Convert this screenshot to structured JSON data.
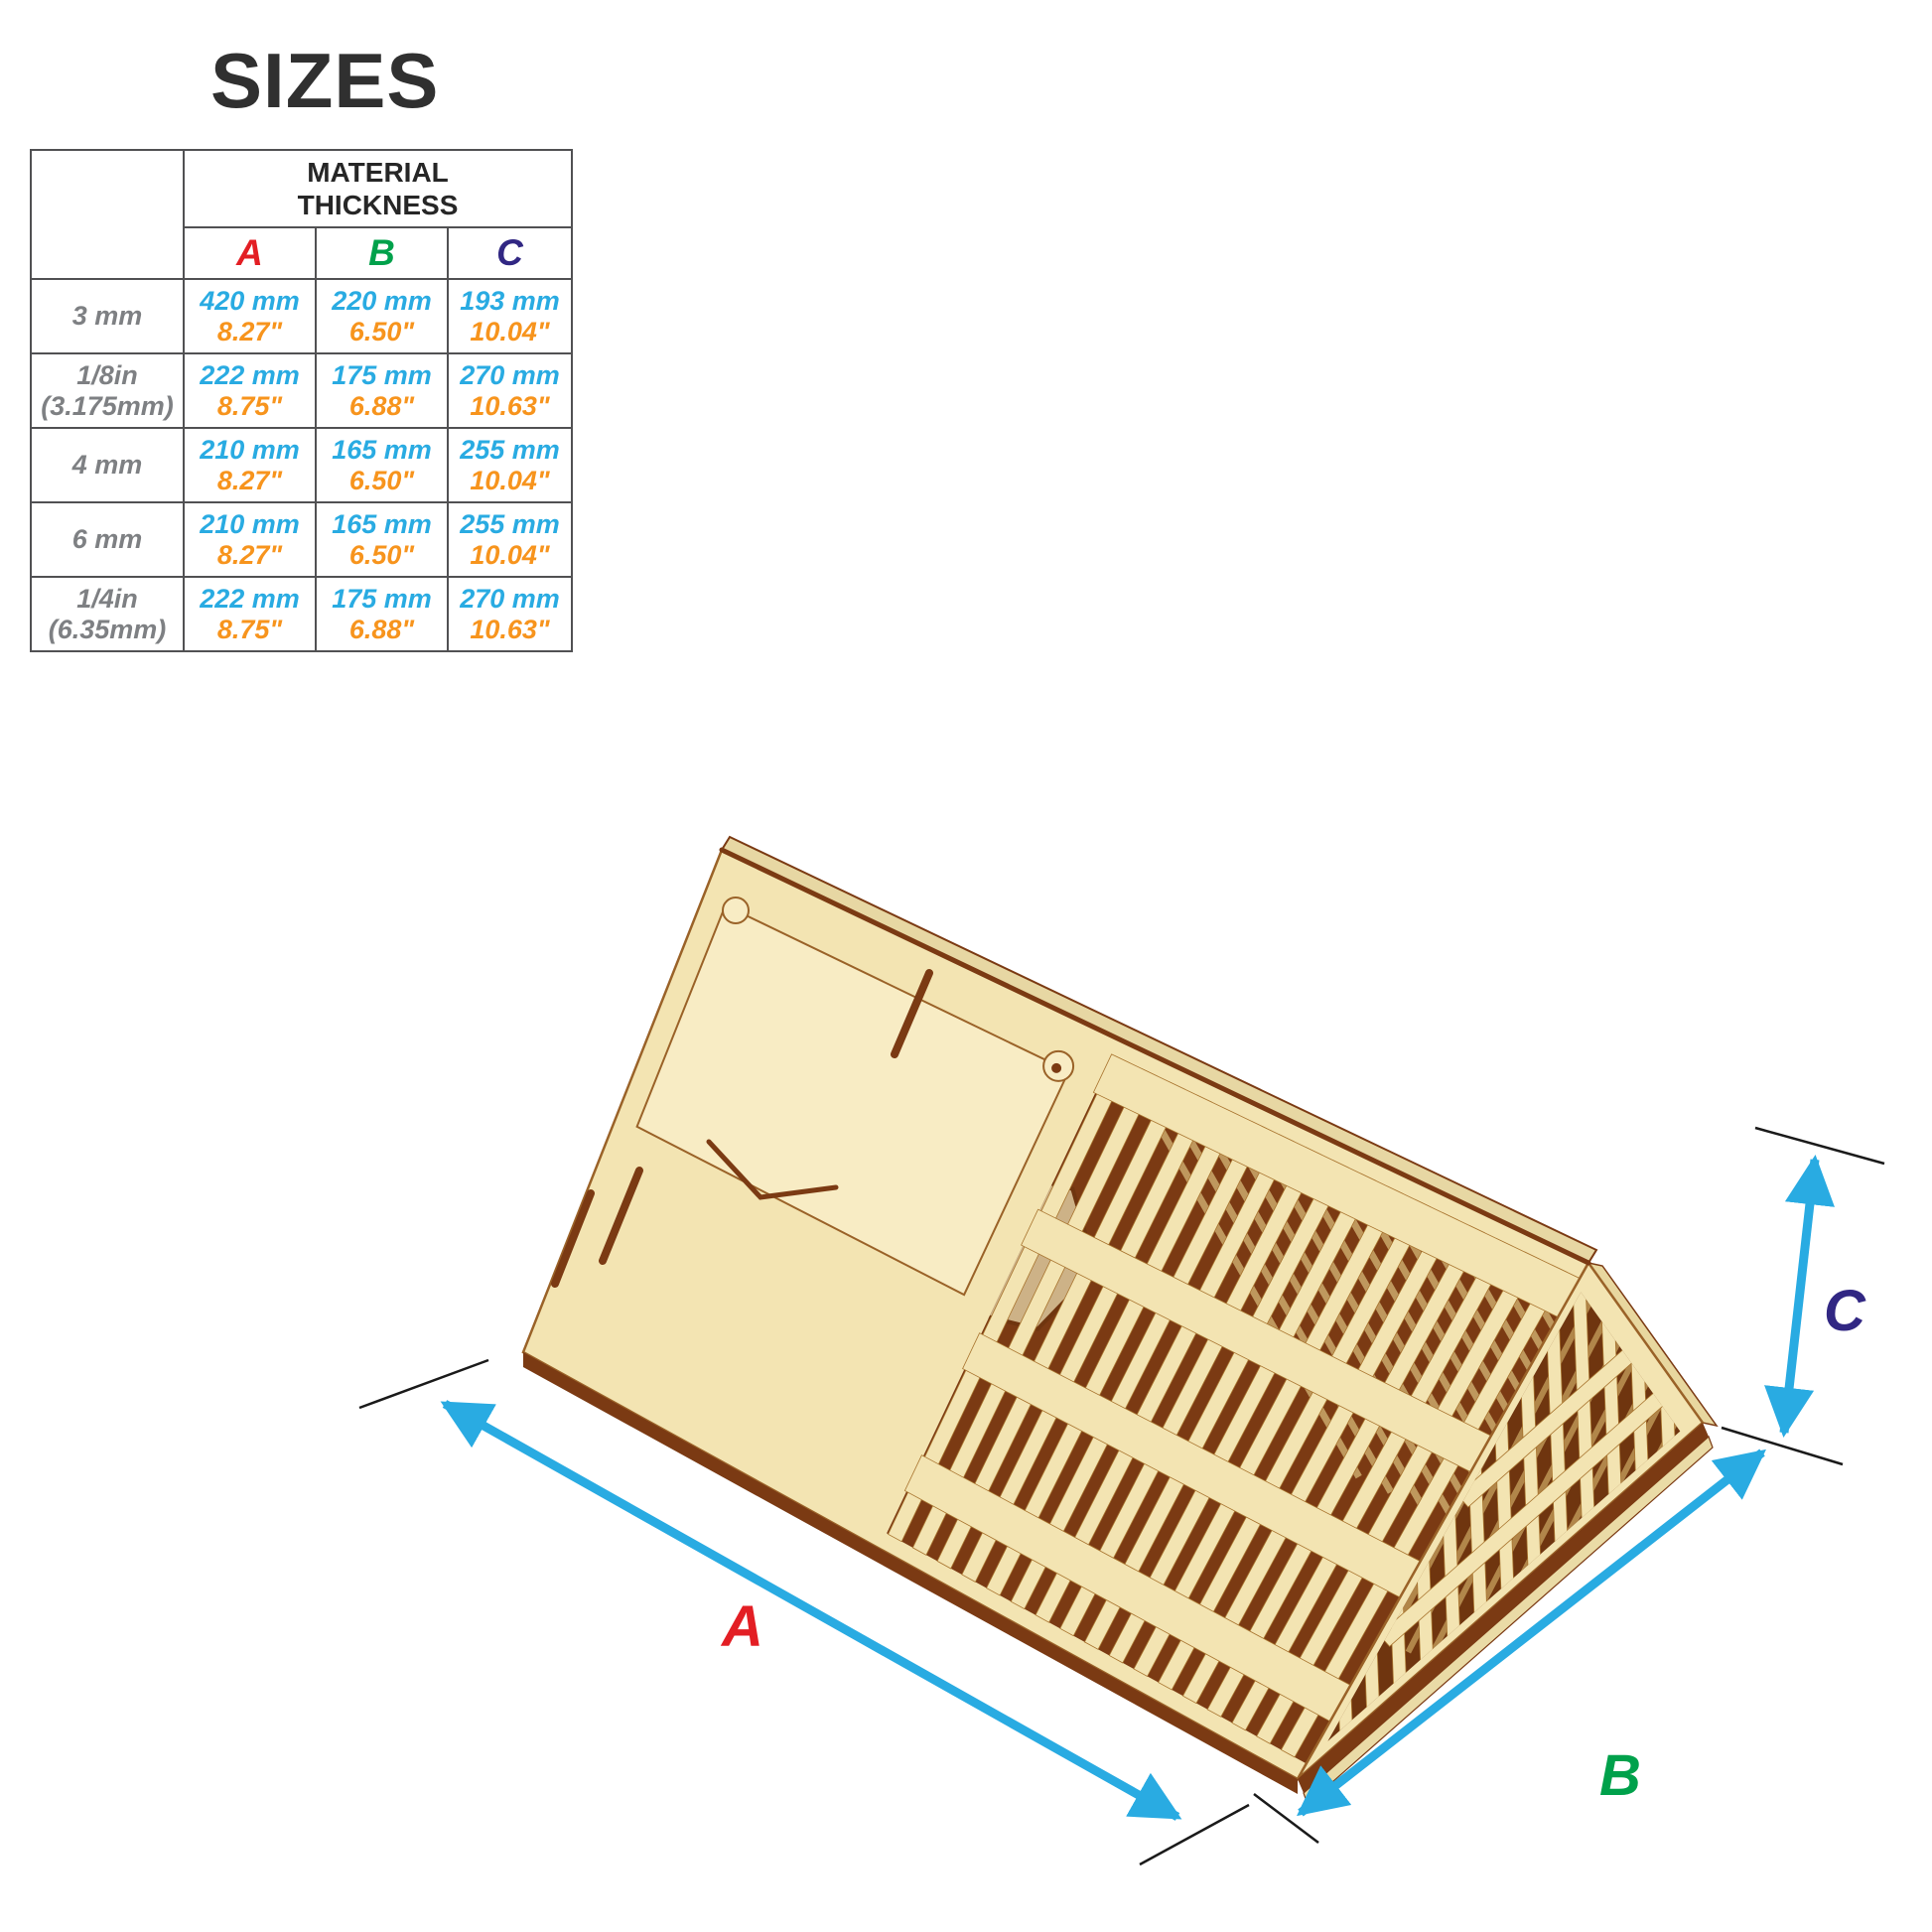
{
  "title": "SIZES",
  "table": {
    "corner_label": "",
    "header_line1": "MATERIAL",
    "header_line2": "THICKNESS",
    "columns": [
      {
        "key": "A",
        "color": "#E31E24"
      },
      {
        "key": "B",
        "color": "#00A14B"
      },
      {
        "key": "C",
        "color": "#312783"
      }
    ],
    "rows": [
      {
        "label1": "3 mm",
        "label2": "",
        "cells": [
          {
            "mm": "420 mm",
            "in": "8.27\""
          },
          {
            "mm": "220 mm",
            "in": "6.50\""
          },
          {
            "mm": "193 mm",
            "in": "10.04\""
          }
        ]
      },
      {
        "label1": "1/8in",
        "label2": "(3.175mm)",
        "cells": [
          {
            "mm": "222 mm",
            "in": "8.75\""
          },
          {
            "mm": "175 mm",
            "in": "6.88\""
          },
          {
            "mm": "270 mm",
            "in": "10.63\""
          }
        ]
      },
      {
        "label1": "4 mm",
        "label2": "",
        "cells": [
          {
            "mm": "210 mm",
            "in": "8.27\""
          },
          {
            "mm": "165 mm",
            "in": "6.50\""
          },
          {
            "mm": "255 mm",
            "in": "10.04\""
          }
        ]
      },
      {
        "label1": "6 mm",
        "label2": "",
        "cells": [
          {
            "mm": "210 mm",
            "in": "8.27\""
          },
          {
            "mm": "165 mm",
            "in": "6.50\""
          },
          {
            "mm": "255 mm",
            "in": "10.04\""
          }
        ]
      },
      {
        "label1": "1/4in",
        "label2": "(6.35mm)",
        "cells": [
          {
            "mm": "222 mm",
            "in": "8.75\""
          },
          {
            "mm": "175 mm",
            "in": "6.88\""
          },
          {
            "mm": "270 mm",
            "in": "10.63\""
          }
        ]
      }
    ]
  },
  "figure": {
    "labels": {
      "a": "A",
      "b": "B",
      "c": "C"
    },
    "colors": {
      "dimension_arrow": "#29ABE2",
      "label_a": "#E31E24",
      "label_b": "#00A14B",
      "label_c": "#312783",
      "mm_text": "#29ABE2",
      "inch_text": "#F7941D",
      "wood_face": "#F3E4B2",
      "wood_door": "#F8ECC4",
      "wood_cut_edge": "#7B3A13",
      "wood_inner_tan": "#CDB287"
    }
  }
}
